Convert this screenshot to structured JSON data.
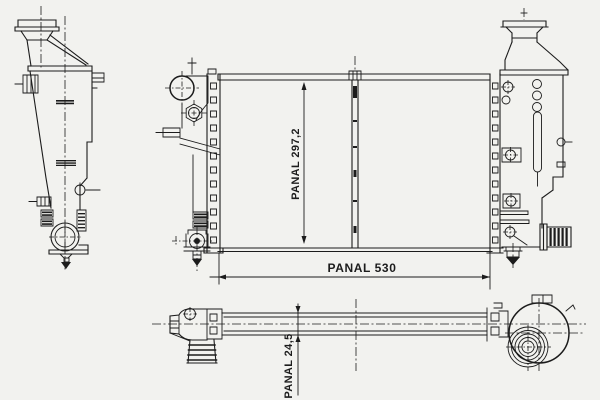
{
  "labels": {
    "core_height": "PANAL 297,2",
    "core_width": "PANAL 530",
    "core_depth": "PANAL 24,5"
  },
  "colors": {
    "background": "#f2f2ef",
    "line": "#1c1c1c"
  }
}
